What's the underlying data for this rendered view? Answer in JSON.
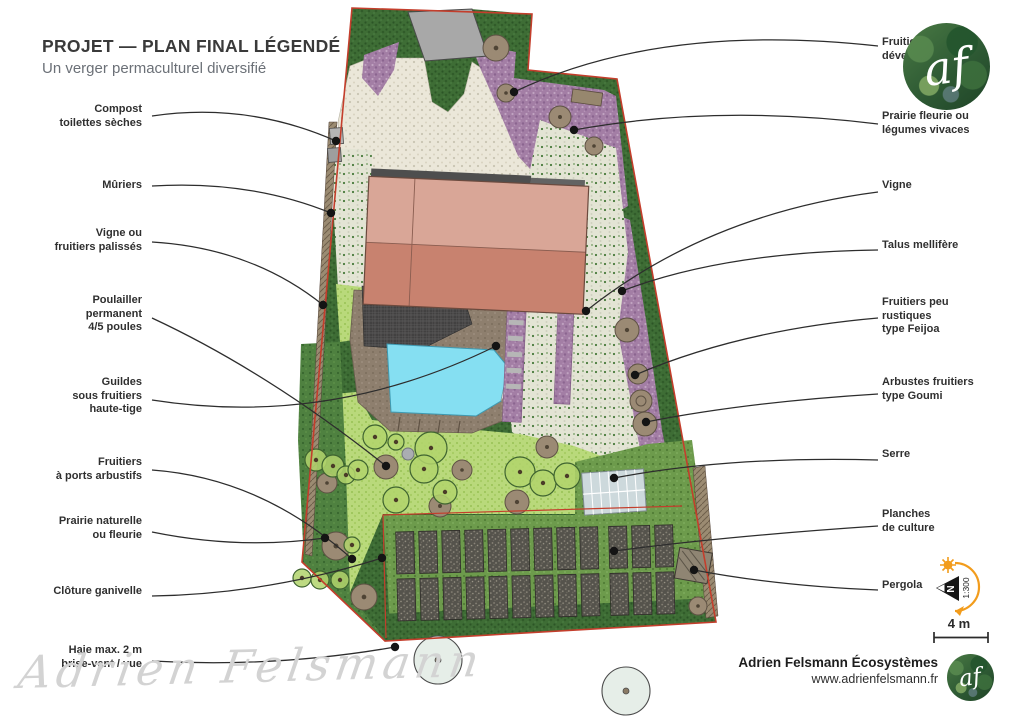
{
  "title": {
    "main": "PROJET — PLAN FINAL LÉGENDÉ",
    "subtitle": "Un verger permaculturel diversifié"
  },
  "labels_left": [
    {
      "id": "compost",
      "text": "Compost\ntoilettes sèches"
    },
    {
      "id": "muriers",
      "text": "Mûriers"
    },
    {
      "id": "vigne-palisses",
      "text": "Vigne ou\nfruitiers palissés"
    },
    {
      "id": "poulailler",
      "text": "Poulailler\npermanent\n4/5 poules"
    },
    {
      "id": "guildes",
      "text": "Guildes\nsous fruitiers\nhaute-tige"
    },
    {
      "id": "fruitiers-arbustifs",
      "text": "Fruitiers\nà ports arbustifs"
    },
    {
      "id": "prairie-naturelle",
      "text": "Prairie naturelle\nou fleurie"
    },
    {
      "id": "cloture",
      "text": "Clôture ganivelle"
    },
    {
      "id": "haie",
      "text": "Haie  max. 2 m\nbrise-vent / vue"
    }
  ],
  "labels_right": [
    {
      "id": "fruitiers-developpes",
      "text": "Fruitiers\ndéveloppés"
    },
    {
      "id": "prairie-fleurie",
      "text": "Prairie fleurie ou\nlégumes vivaces"
    },
    {
      "id": "vigne",
      "text": "Vigne"
    },
    {
      "id": "talus",
      "text": "Talus mellifère"
    },
    {
      "id": "feijoa",
      "text": "Fruitiers peu\nrustiques\ntype Feijoa"
    },
    {
      "id": "goumi",
      "text": "Arbustes fruitiers\ntype Goumi"
    },
    {
      "id": "serre",
      "text": "Serre"
    },
    {
      "id": "planches",
      "text": "Planches\nde culture"
    },
    {
      "id": "pergola",
      "text": "Pergola"
    }
  ],
  "leaders": [
    {
      "from": [
        152,
        116
      ],
      "ctrl": [
        248,
        102
      ],
      "to": [
        336,
        141
      ]
    },
    {
      "from": [
        152,
        186
      ],
      "ctrl": [
        250,
        180
      ],
      "to": [
        331,
        213
      ]
    },
    {
      "from": [
        152,
        242
      ],
      "ctrl": [
        252,
        248
      ],
      "to": [
        323,
        305
      ]
    },
    {
      "from": [
        152,
        318
      ],
      "ctrl": [
        268,
        372
      ],
      "to": [
        386,
        466
      ]
    },
    {
      "from": [
        152,
        400
      ],
      "ctrl": [
        330,
        428
      ],
      "to": [
        496,
        346
      ]
    },
    {
      "from": [
        152,
        470
      ],
      "ctrl": [
        262,
        478
      ],
      "to": [
        352,
        559
      ]
    },
    {
      "from": [
        152,
        532
      ],
      "ctrl": [
        240,
        550
      ],
      "to": [
        325,
        538
      ]
    },
    {
      "from": [
        152,
        596
      ],
      "ctrl": [
        268,
        594
      ],
      "to": [
        382,
        558
      ]
    },
    {
      "from": [
        152,
        661
      ],
      "ctrl": [
        275,
        668
      ],
      "to": [
        395,
        647
      ]
    },
    {
      "from": [
        878,
        46
      ],
      "ctrl": [
        660,
        22
      ],
      "to": [
        514,
        92
      ]
    },
    {
      "from": [
        878,
        124
      ],
      "ctrl": [
        716,
        104
      ],
      "to": [
        574,
        130
      ]
    },
    {
      "from": [
        878,
        192
      ],
      "ctrl": [
        708,
        214
      ],
      "to": [
        586,
        311
      ]
    },
    {
      "from": [
        878,
        250
      ],
      "ctrl": [
        724,
        252
      ],
      "to": [
        622,
        291
      ]
    },
    {
      "from": [
        878,
        318
      ],
      "ctrl": [
        740,
        330
      ],
      "to": [
        635,
        375
      ]
    },
    {
      "from": [
        878,
        394
      ],
      "ctrl": [
        748,
        402
      ],
      "to": [
        646,
        422
      ]
    },
    {
      "from": [
        878,
        460
      ],
      "ctrl": [
        730,
        456
      ],
      "to": [
        614,
        478
      ]
    },
    {
      "from": [
        878,
        526
      ],
      "ctrl": [
        728,
        536
      ],
      "to": [
        614,
        551
      ]
    },
    {
      "from": [
        878,
        590
      ],
      "ctrl": [
        778,
        586
      ],
      "to": [
        694,
        570
      ]
    }
  ],
  "plan": {
    "trees_brown": [
      [
        496,
        48,
        13
      ],
      [
        506,
        93,
        9
      ],
      [
        560,
        117,
        11
      ],
      [
        594,
        146,
        9
      ],
      [
        627,
        330,
        12
      ],
      [
        638,
        374,
        10
      ],
      [
        645,
        424,
        12
      ],
      [
        386,
        467,
        12
      ],
      [
        462,
        470,
        10
      ],
      [
        547,
        447,
        11
      ],
      [
        517,
        502,
        12
      ],
      [
        327,
        483,
        10
      ],
      [
        336,
        546,
        14
      ],
      [
        364,
        597,
        13
      ],
      [
        440,
        506,
        11
      ],
      [
        698,
        606,
        9
      ]
    ],
    "trees_gray": [
      [
        408,
        454,
        6
      ]
    ],
    "trees_canopy": [
      [
        375,
        437,
        12
      ],
      [
        396,
        442,
        8
      ],
      [
        431,
        448,
        16
      ],
      [
        424,
        469,
        14
      ],
      [
        396,
        500,
        13
      ],
      [
        520,
        472,
        15
      ],
      [
        543,
        483,
        13
      ],
      [
        567,
        476,
        13
      ],
      [
        316,
        460,
        11
      ],
      [
        333,
        466,
        11
      ],
      [
        346,
        475,
        9
      ],
      [
        302,
        578,
        9
      ],
      [
        320,
        580,
        9
      ],
      [
        340,
        580,
        9
      ],
      [
        352,
        545,
        8
      ],
      [
        445,
        492,
        12
      ],
      [
        358,
        470,
        10
      ]
    ],
    "tree_goumi": [
      641,
      401,
      11
    ],
    "trees_outside": [
      [
        438,
        660,
        24
      ],
      [
        626,
        691,
        24
      ]
    ],
    "beds": {
      "rows": 2,
      "cols": 12,
      "x0": 397,
      "y0": 528,
      "w": 18,
      "h": 42,
      "pitch_x": 23,
      "pitch_y": 47,
      "gap_after_col": 9,
      "extra_gap": 6
    },
    "serre": {
      "x": 583,
      "y": 471,
      "w": 62,
      "h": 42,
      "cols": 7
    }
  },
  "compass": {
    "north": "N",
    "scale": "1:300"
  },
  "scale_bar": {
    "label": "4 m"
  },
  "branding": {
    "company": "Adrien Felsmann Écosystèmes",
    "website": "www.adrienfelsmann.fr",
    "monogram": "af"
  },
  "watermark": "Adrien Felsmann",
  "colors": {
    "boundary_red": "#c43e2c",
    "hedge_green": "#3e6d35",
    "meadow_green": "#b9d97b",
    "bed_zone_green": "#6d9b4c",
    "flower_purple": "#a37ea5",
    "gravel_cream": "#ebe7d9",
    "roof_light": "#d9a697",
    "roof_dark": "#c8826f",
    "pool_blue": "#85dff2",
    "deck_brown": "#8e7f6e",
    "accent_orange": "#f29c1c",
    "label_text": "#2f2f2f"
  }
}
